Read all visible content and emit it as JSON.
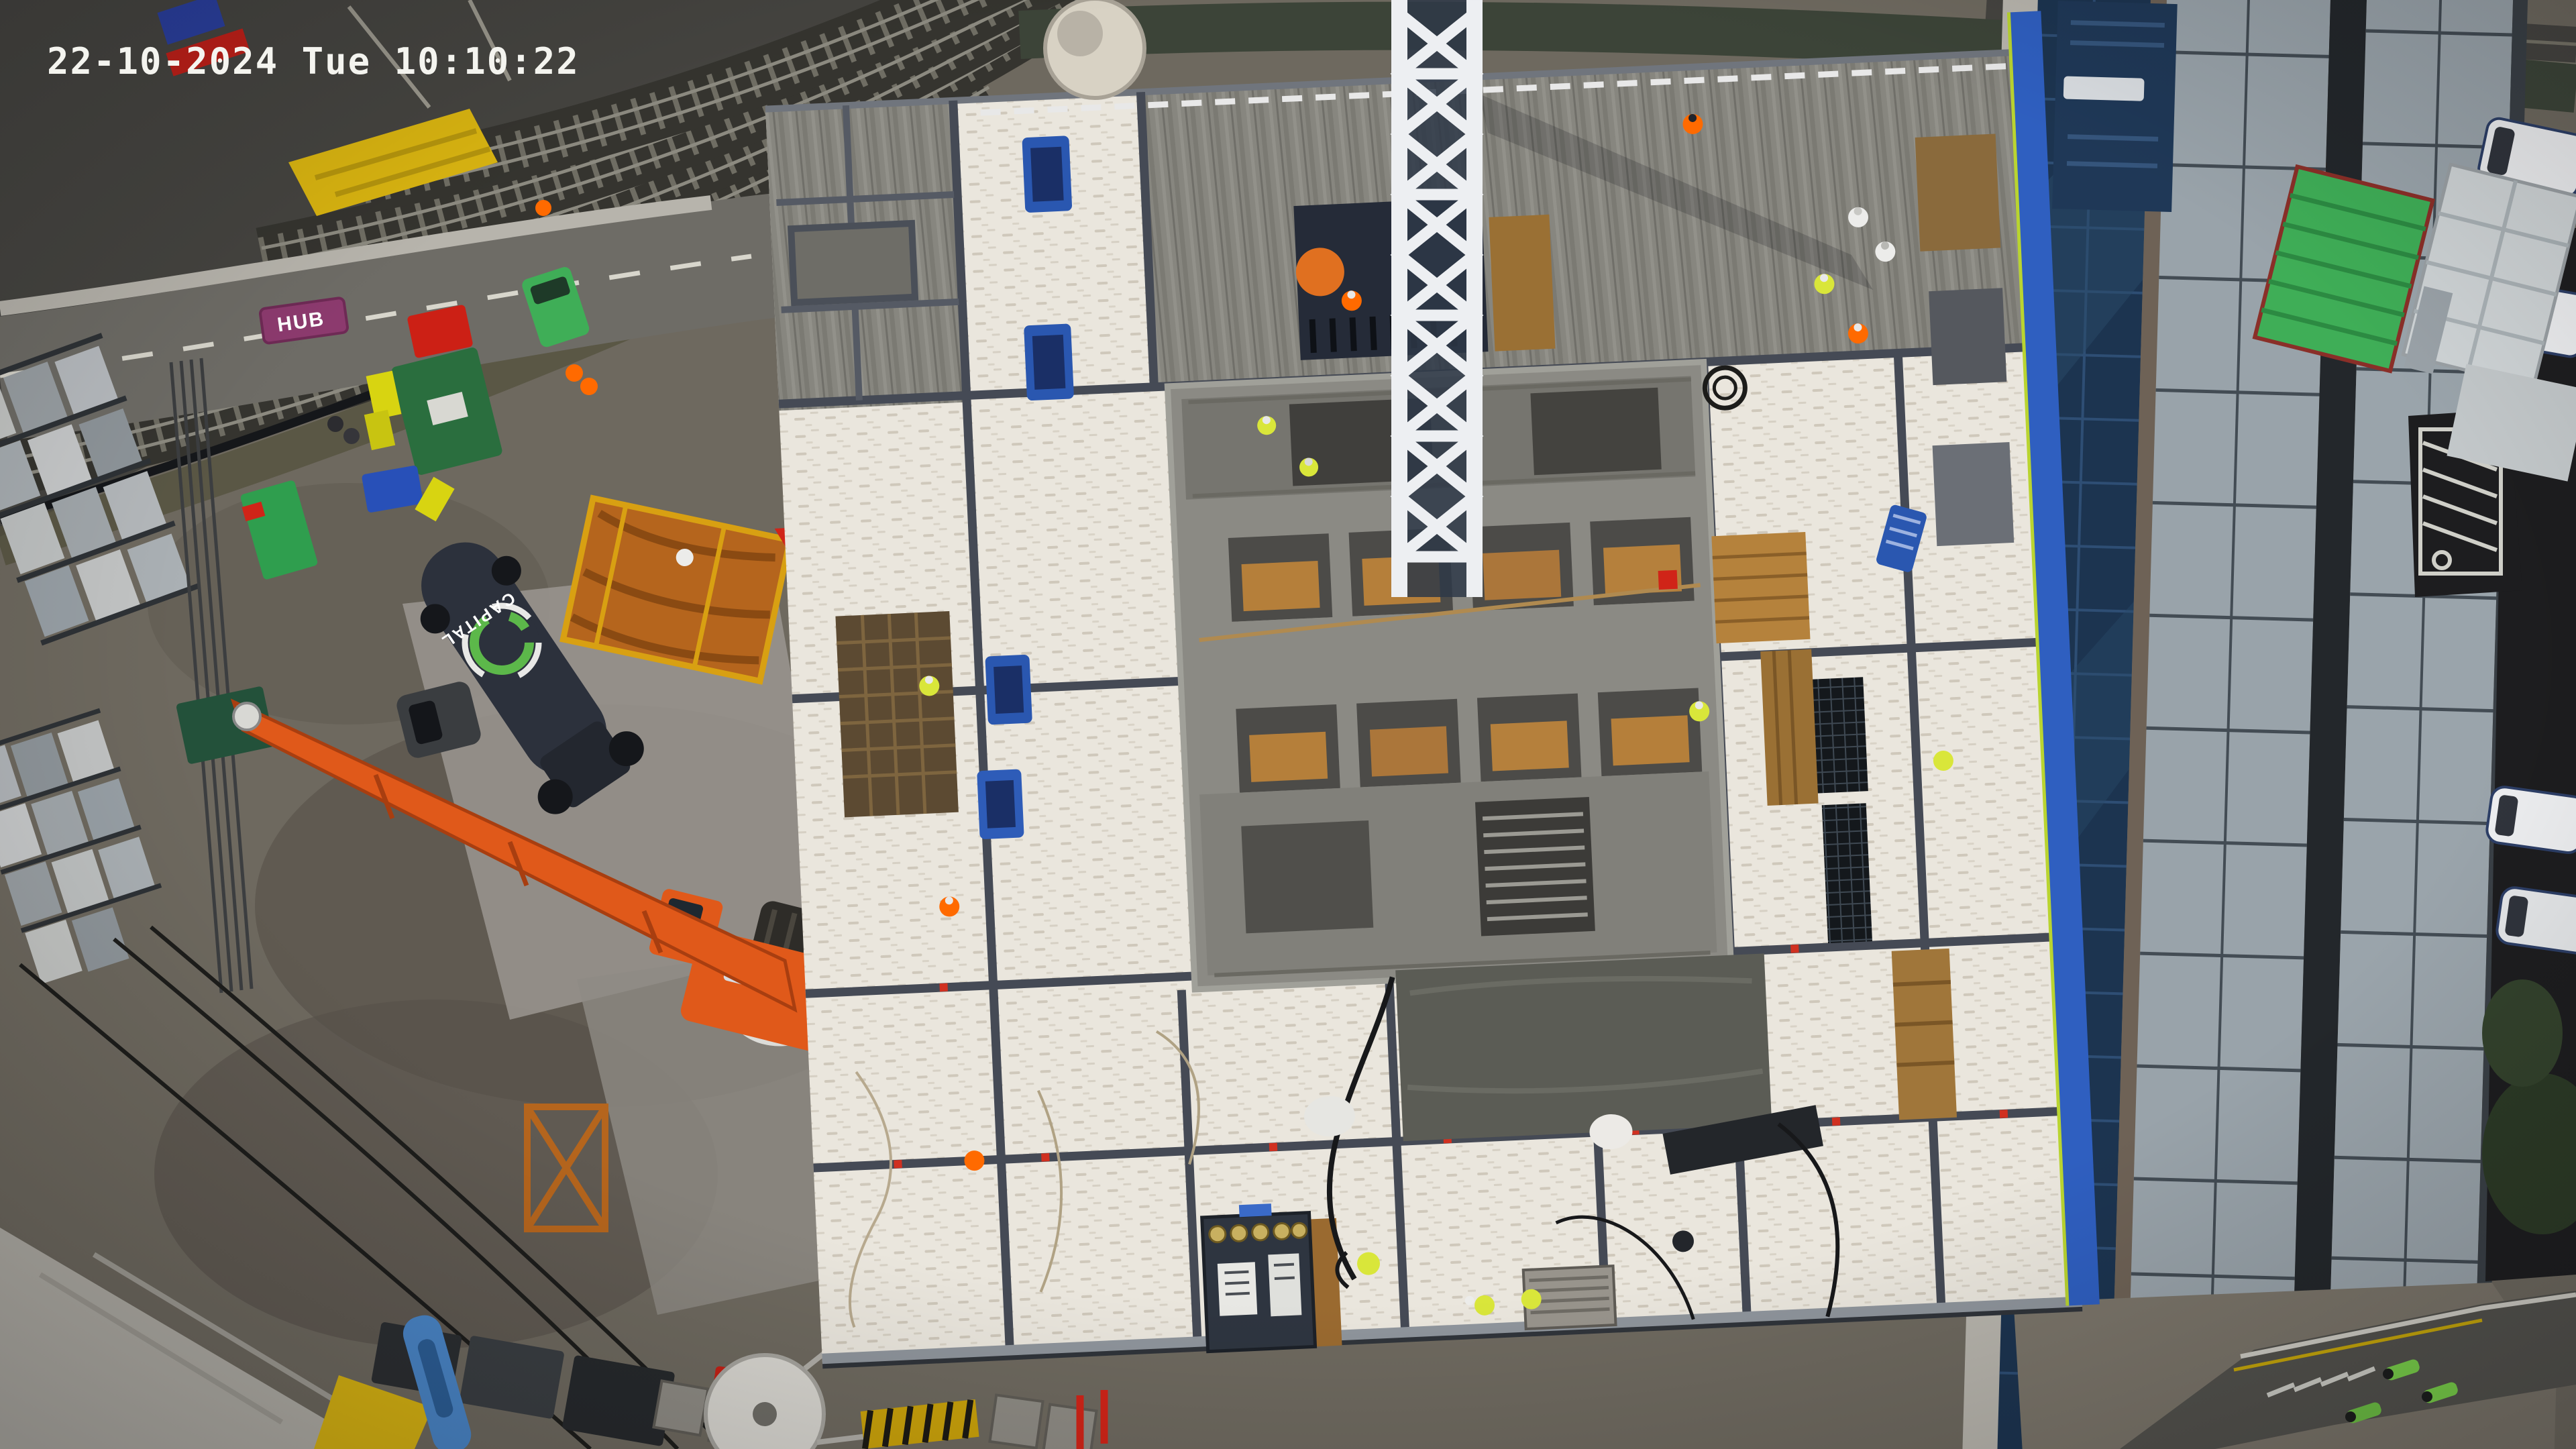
{
  "overlay": {
    "timestamp": "22-10-2024 Tue 10:10:22"
  },
  "texts": {
    "truck_logo": "CAPITAL",
    "road_barrier_sign": "HUB"
  },
  "scene_palette": {
    "bg_mud": "#6e695f",
    "mud_dark": "#5a544b",
    "paving": "#b2afa7",
    "apron": "#9b9790",
    "ballast": "#454440",
    "rail": "#8c8a80",
    "hedge": "#3c4438",
    "road": "#6e6c66",
    "road_dark": "#1d1d1f",
    "mark_white": "#d8d6cc",
    "hoarding_yellow": "#d9b411",
    "deck": "#eae6dd",
    "deck_dash": "#cfc8bb",
    "beam": "#454a55",
    "slab": "#87867f",
    "slab_dark": "#7b7a73",
    "core": "#8b8a84",
    "void_dark": "#403f3c",
    "formwork": "#b57f3a",
    "wet": "#5b5c55",
    "mast_white": "#edeff2",
    "mast_dark": "#2e3848",
    "hoarding_blue": "#2f5fc0",
    "glass_navy": "#1c3450",
    "roof_gray": "#99a3aa",
    "gutter": "#23272b",
    "station_navy": "#1f3857",
    "van_white": "#edeef0",
    "crane_orange": "#e0591a",
    "truck_navy": "#2c313c",
    "logo_green": "#5cb84a",
    "green_dark": "#2a6e3e",
    "green_bright": "#3fae57",
    "red": "#cc2015",
    "blue": "#2a57b0",
    "bin_yellow": "#d8d411",
    "timber": "#a0763a",
    "worker_orange": "#ff6a00",
    "worker_yellow": "#d9e63a",
    "worker_white": "#ececea",
    "timestamp": "#f4f4ef"
  }
}
